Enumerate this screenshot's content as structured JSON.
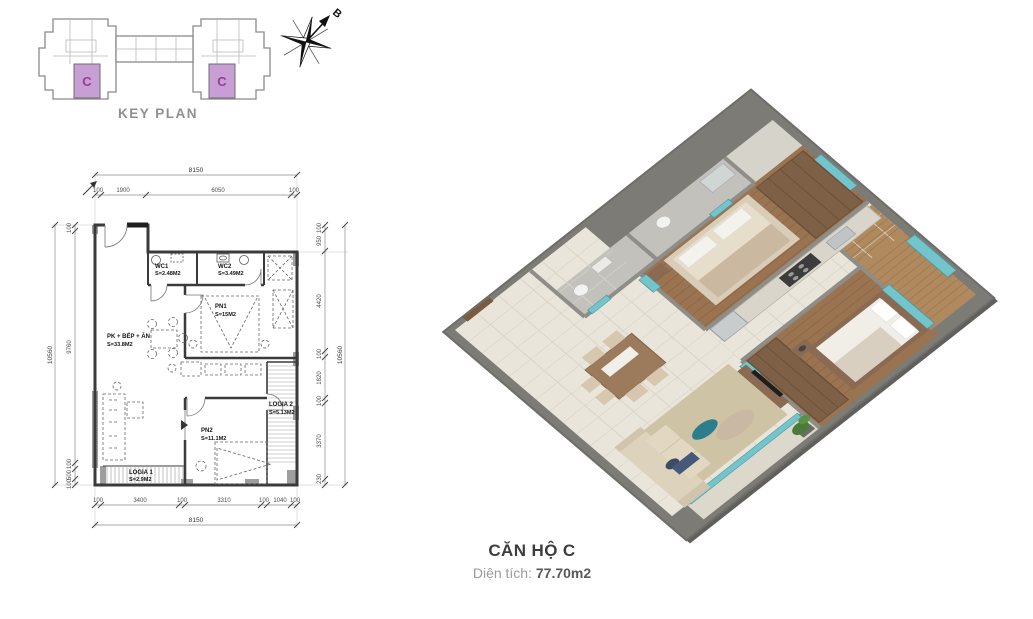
{
  "key_plan": {
    "title": "KEY PLAN",
    "units": [
      "C",
      "C"
    ],
    "highlight_color": "#c89fd5",
    "unit_letter_color": "#93408f",
    "compass_label": "B"
  },
  "floor_plan": {
    "rooms": {
      "wc1": {
        "name": "WC1",
        "area": "S=2.48M2"
      },
      "wc2": {
        "name": "WC2",
        "area": "S=3.49M2"
      },
      "pn1": {
        "name": "PN1",
        "area": "S=15M2"
      },
      "living": {
        "name": "PK + BẾP + ĂN",
        "area": "S=33.8M2"
      },
      "pn2": {
        "name": "PN2",
        "area": "S=11.1M2"
      },
      "logia1": {
        "name": "LOGIA 1",
        "area": "S=2.9M2"
      },
      "logia2": {
        "name": "LOGIA 2",
        "area": "S=5.13M2"
      }
    },
    "dims": {
      "top_total": "8150",
      "top": [
        "100",
        "1900",
        "6050",
        "100"
      ],
      "bottom": [
        "100",
        "3400",
        "100",
        "3310",
        "100",
        "1040",
        "100"
      ],
      "bottom_total": "8150",
      "left_total": "10560",
      "left": [
        "100",
        "9760",
        "100",
        "500",
        "100"
      ],
      "right": [
        "100",
        "950",
        "4420",
        "100",
        "1820",
        "100",
        "3370",
        "230"
      ],
      "right_total": "10560"
    }
  },
  "render": {
    "glass_color": "#74c4cb",
    "wood_color": "#9a7451",
    "wall_color": "#8f8d88"
  },
  "caption": {
    "title": "CĂN HỘ C",
    "area_label": "Diện tích:",
    "area_value": "77.70m2"
  }
}
